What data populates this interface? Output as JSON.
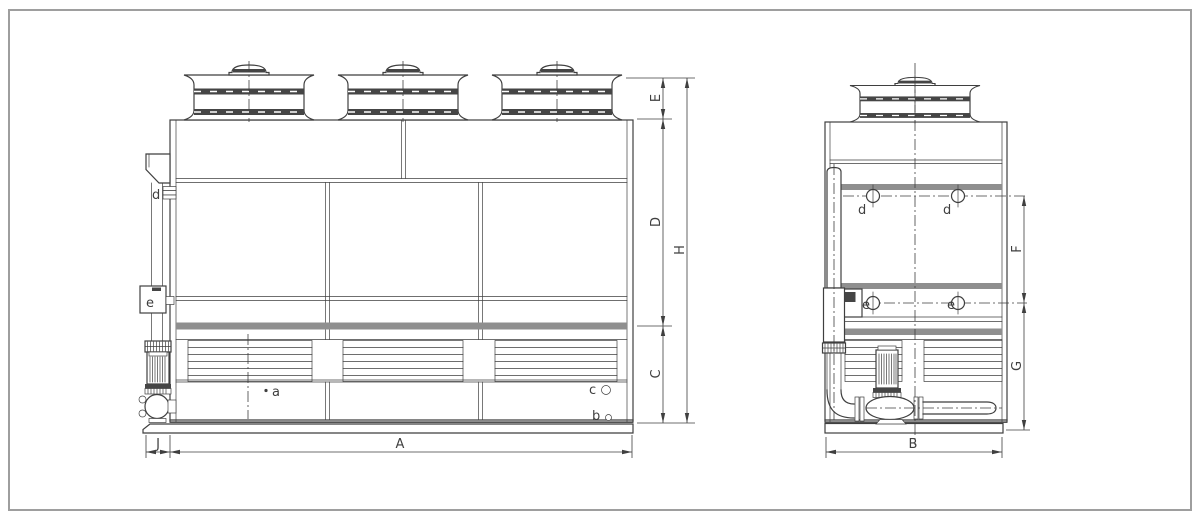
{
  "front_view": {
    "dims": {
      "E": "E",
      "D": "D",
      "C": "C",
      "H": "H",
      "A": "A",
      "J": "J"
    }
  },
  "side_view": {
    "dims": {
      "F": "F",
      "G": "G",
      "B": "B"
    }
  },
  "ports": {
    "a": "a",
    "b": "b",
    "c": "c",
    "d": "d",
    "e": "e"
  }
}
